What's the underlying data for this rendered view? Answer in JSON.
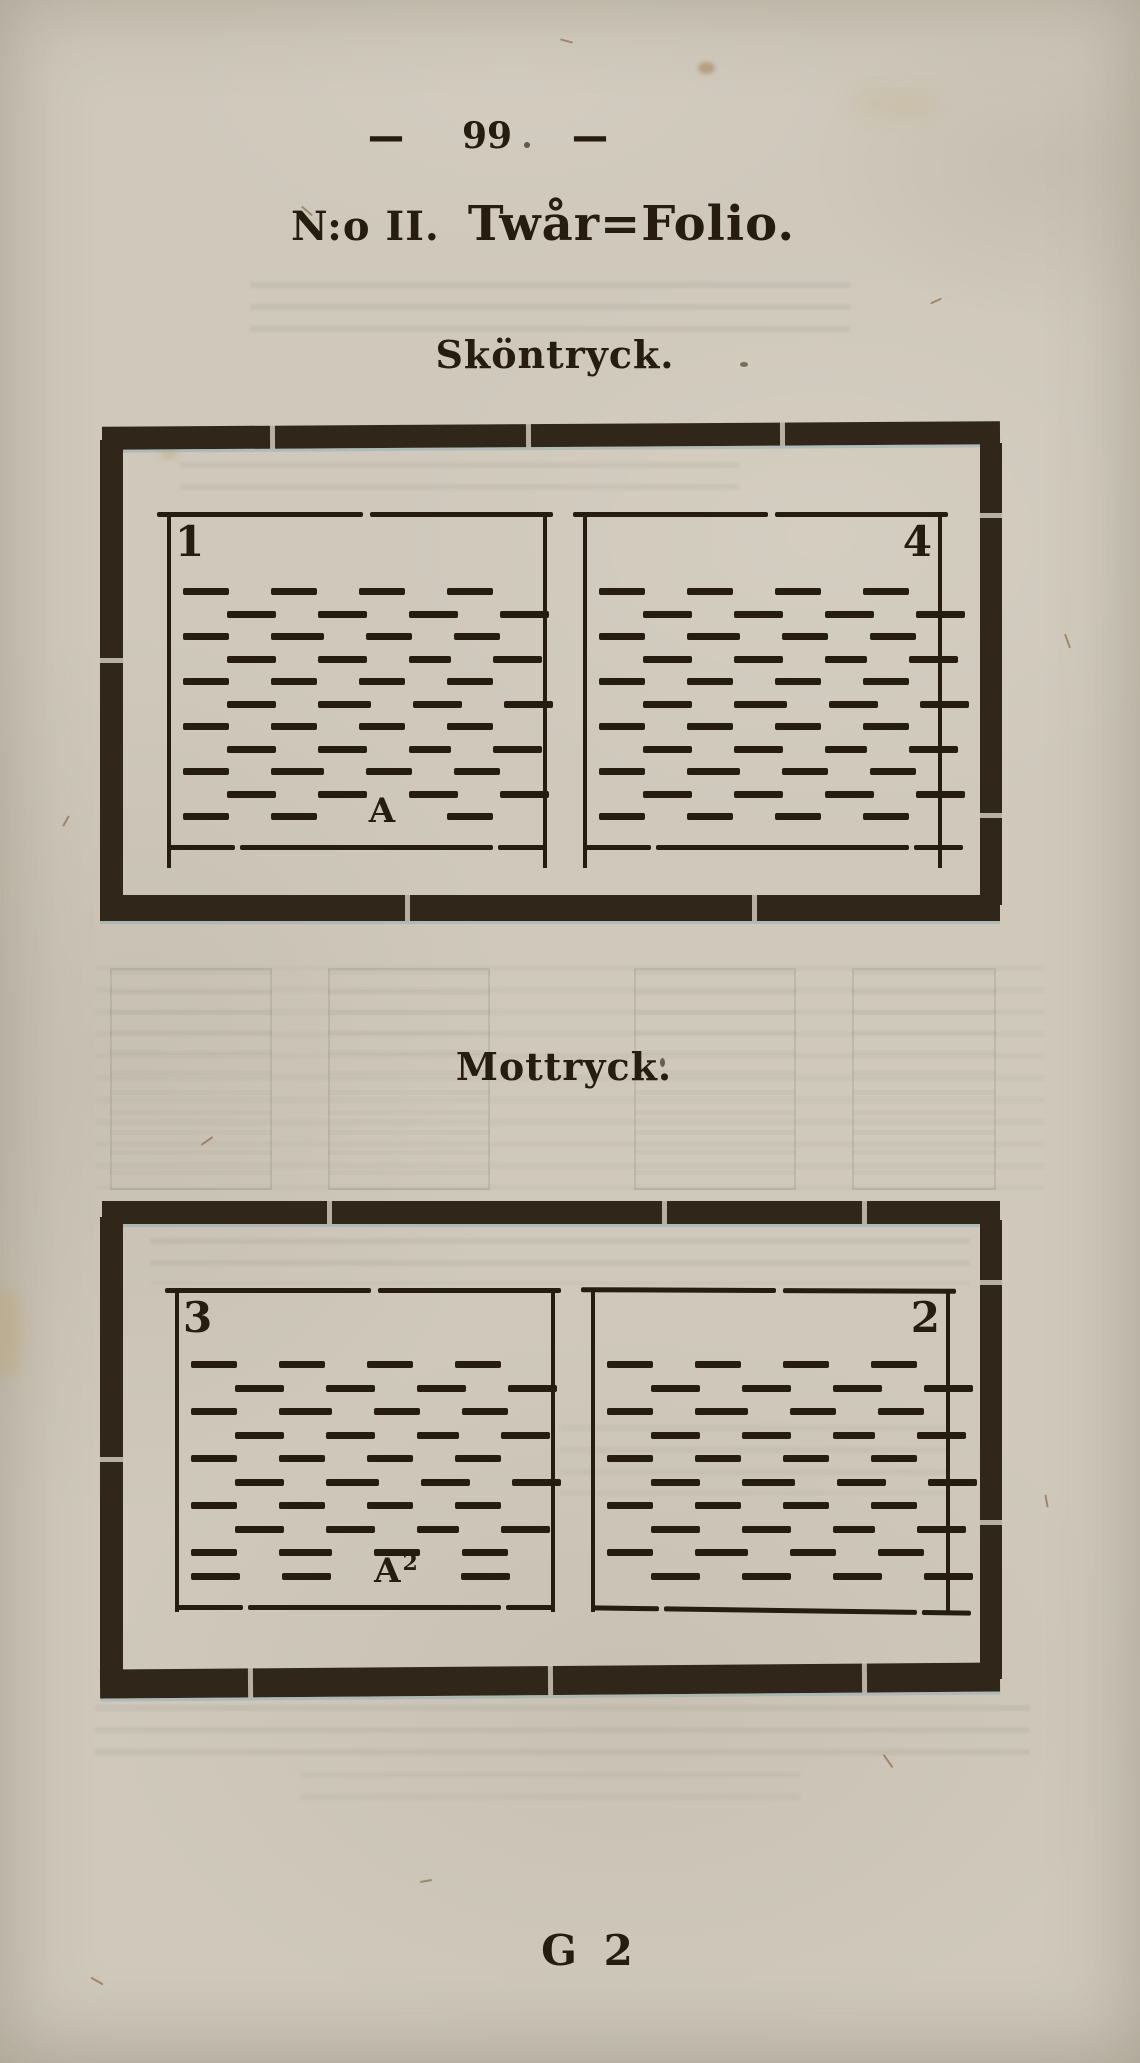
{
  "page": {
    "header": {
      "rule_left": "—",
      "number": "99",
      "rule_right": "—"
    },
    "title": {
      "prefix": "N:o II.",
      "main": "Twår=Folio."
    },
    "footer_signature": "G 2"
  },
  "diagrams": [
    {
      "heading": "Sköntryck.",
      "pages": [
        {
          "number": "1",
          "number_side": "left",
          "signature_base": "A",
          "signature_sub": "",
          "dash_rows": 11
        },
        {
          "number": "4",
          "number_side": "right",
          "signature_base": "",
          "signature_sub": "",
          "dash_rows": 11
        }
      ]
    },
    {
      "heading": "Mottryck.",
      "pages": [
        {
          "number": "3",
          "number_side": "left",
          "signature_base": "A",
          "signature_sub": "2",
          "dash_rows": 10
        },
        {
          "number": "2",
          "number_side": "right",
          "signature_base": "",
          "signature_sub": "",
          "dash_rows": 10
        }
      ]
    }
  ],
  "colors": {
    "paper": "#cfc8bb",
    "ink": "#261c10",
    "frame": "#30261a"
  }
}
